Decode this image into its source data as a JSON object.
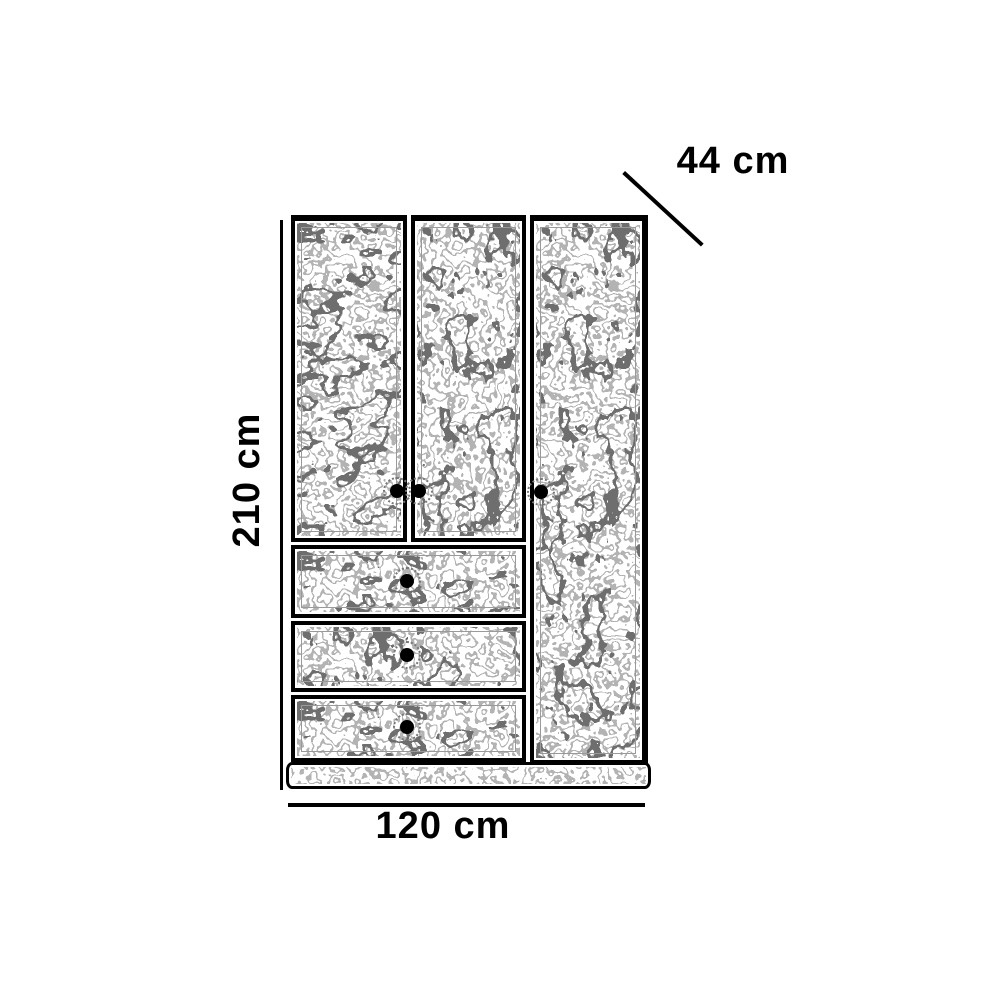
{
  "diagram": {
    "background_color": "#ffffff",
    "line_color": "#000000",
    "sketch_color_light": "#b3b3b3",
    "sketch_color_dark": "#6e6e6e",
    "dimensions": {
      "height": {
        "label": "210 cm"
      },
      "width": {
        "label": "120 cm"
      },
      "depth": {
        "label": "44 cm"
      }
    },
    "furniture": {
      "type": "wardrobe",
      "door_count": 3,
      "drawer_count": 3,
      "knob_count": 6
    }
  }
}
